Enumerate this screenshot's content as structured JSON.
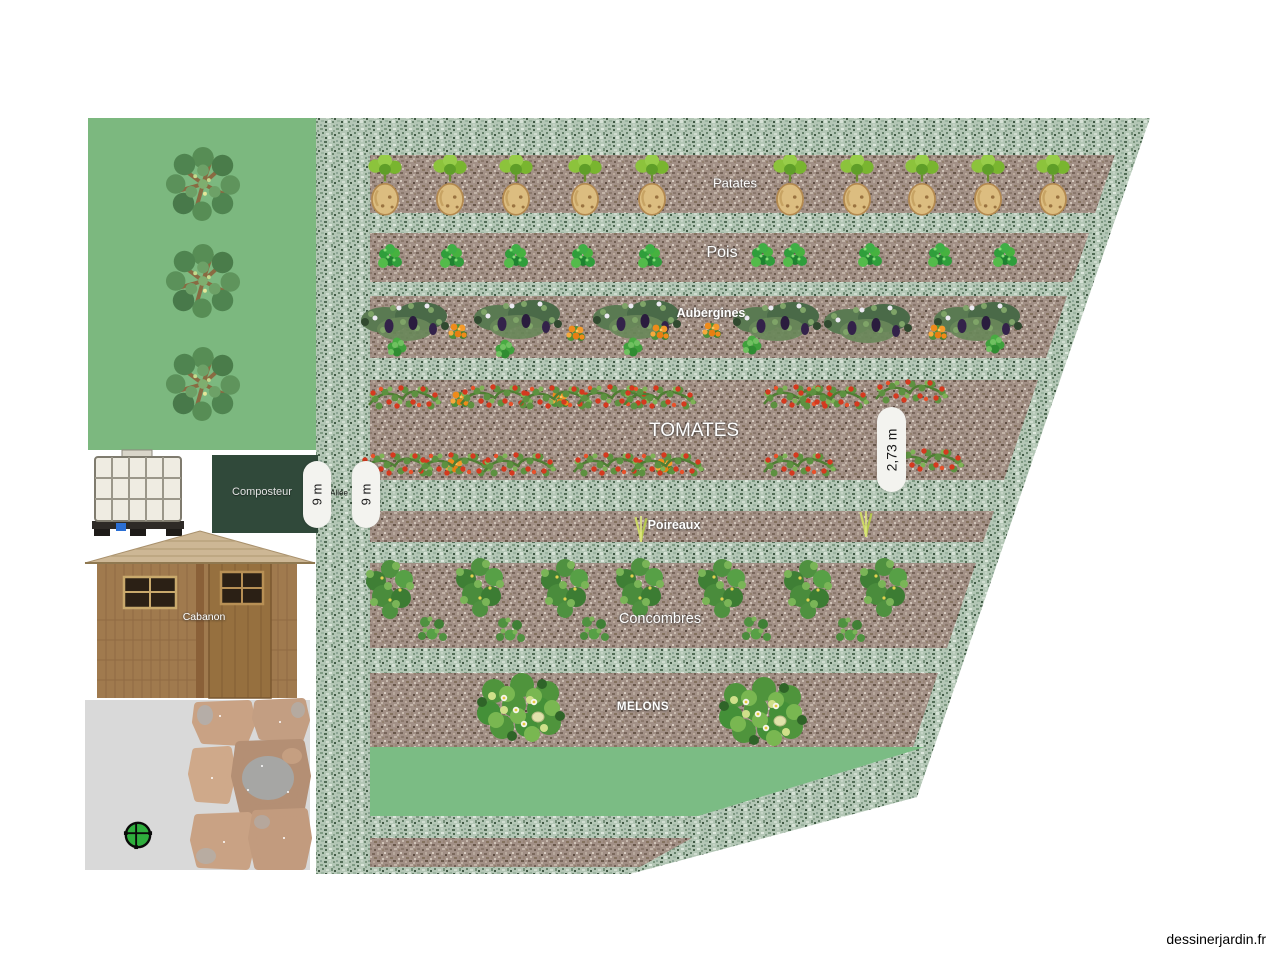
{
  "watermark": "dessinerjardin.fr",
  "rows": [
    {
      "id": "patates",
      "label": "Patates"
    },
    {
      "id": "pois",
      "label": "Pois"
    },
    {
      "id": "aubergines",
      "label": "Aubergines"
    },
    {
      "id": "tomates",
      "label": "TOMATES"
    },
    {
      "id": "poireaux",
      "label": "Poireaux"
    },
    {
      "id": "concombres",
      "label": "Concombres"
    },
    {
      "id": "melons",
      "label": "MELONS"
    }
  ],
  "structures": {
    "composter_label": "Composteur",
    "shed_label": "Cabanon",
    "path_label": "Allée"
  },
  "measurements": [
    {
      "text": "9 m"
    },
    {
      "text": "9 m"
    },
    {
      "text": "2,73 m"
    }
  ],
  "colors": {
    "lawn": "#7cb87f",
    "lawn_strip": "#7bbc84",
    "gravel_base": "#b4c7b6",
    "soil_base": "#a29086",
    "composter_bg": "#30493a",
    "terrace": "#d9d9d9",
    "pill_bg": "#f3f3ef"
  },
  "plants": [
    {
      "name": "potato-icon",
      "icon": "sym-potato",
      "points": [
        [
          385,
          186
        ],
        [
          450,
          186
        ],
        [
          516,
          186
        ],
        [
          585,
          186
        ],
        [
          652,
          186
        ],
        [
          790,
          186
        ],
        [
          857,
          186
        ],
        [
          922,
          186
        ],
        [
          988,
          186
        ],
        [
          1053,
          186
        ]
      ]
    },
    {
      "name": "pea-icon",
      "icon": "sym-pea",
      "points": [
        [
          390,
          258
        ],
        [
          452,
          258
        ],
        [
          516,
          258
        ],
        [
          583,
          258
        ],
        [
          650,
          258
        ],
        [
          763,
          257
        ],
        [
          795,
          257
        ],
        [
          870,
          257
        ],
        [
          940,
          257
        ],
        [
          1005,
          257
        ]
      ]
    },
    {
      "name": "eggplant-bush-icon",
      "icon": "sym-aubergine",
      "points": [
        [
          405,
          320
        ],
        [
          518,
          318
        ],
        [
          637,
          318
        ],
        [
          777,
          320
        ],
        [
          868,
          322
        ],
        [
          978,
          320
        ]
      ]
    },
    {
      "name": "marigold-icon",
      "icon": "sym-marigold",
      "points": [
        [
          458,
          331
        ],
        [
          576,
          333
        ],
        [
          660,
          332
        ],
        [
          712,
          330
        ],
        [
          938,
          332
        ],
        [
          460,
          399
        ],
        [
          560,
          399
        ],
        [
          455,
          466
        ],
        [
          665,
          466
        ]
      ]
    },
    {
      "name": "grass-tuft-icon",
      "icon": "sym-tuft",
      "points": [
        [
          397,
          347
        ],
        [
          505,
          349
        ],
        [
          633,
          347
        ],
        [
          752,
          345
        ],
        [
          995,
          344
        ]
      ]
    },
    {
      "name": "tomato-plant-icon",
      "icon": "sym-tomato",
      "points": [
        [
          405,
          397
        ],
        [
          497,
          396
        ],
        [
          556,
          397
        ],
        [
          614,
          396
        ],
        [
          660,
          397
        ],
        [
          800,
          396
        ],
        [
          833,
          397
        ],
        [
          912,
          391
        ],
        [
          397,
          464
        ],
        [
          455,
          464
        ],
        [
          520,
          464
        ],
        [
          610,
          464
        ],
        [
          668,
          464
        ],
        [
          800,
          464
        ],
        [
          928,
          460
        ]
      ]
    },
    {
      "name": "leek-icon",
      "icon": "sym-leek",
      "points": [
        [
          641,
          529
        ],
        [
          866,
          524
        ]
      ]
    },
    {
      "name": "cucumber-plant-icon",
      "icon": "sym-cucumber",
      "points": [
        [
          390,
          588
        ],
        [
          480,
          586
        ],
        [
          565,
          587
        ],
        [
          640,
          586
        ],
        [
          722,
          587
        ],
        [
          808,
          588
        ],
        [
          884,
          586
        ]
      ]
    },
    {
      "name": "cucumber-seedling-icon",
      "icon": "sym-cuke-small",
      "points": [
        [
          432,
          628
        ],
        [
          510,
          629
        ],
        [
          594,
          628
        ],
        [
          756,
          628
        ],
        [
          850,
          629
        ]
      ]
    },
    {
      "name": "melon-plant-icon",
      "icon": "sym-melon",
      "points": [
        [
          522,
          708
        ],
        [
          764,
          712
        ]
      ]
    },
    {
      "name": "tree-icon",
      "icon": "sym-tree",
      "points": [
        [
          203,
          184
        ],
        [
          203,
          281
        ],
        [
          203,
          384
        ]
      ]
    },
    {
      "name": "round-table-icon",
      "icon": "sym-table",
      "points": [
        [
          138,
          835
        ]
      ]
    }
  ]
}
